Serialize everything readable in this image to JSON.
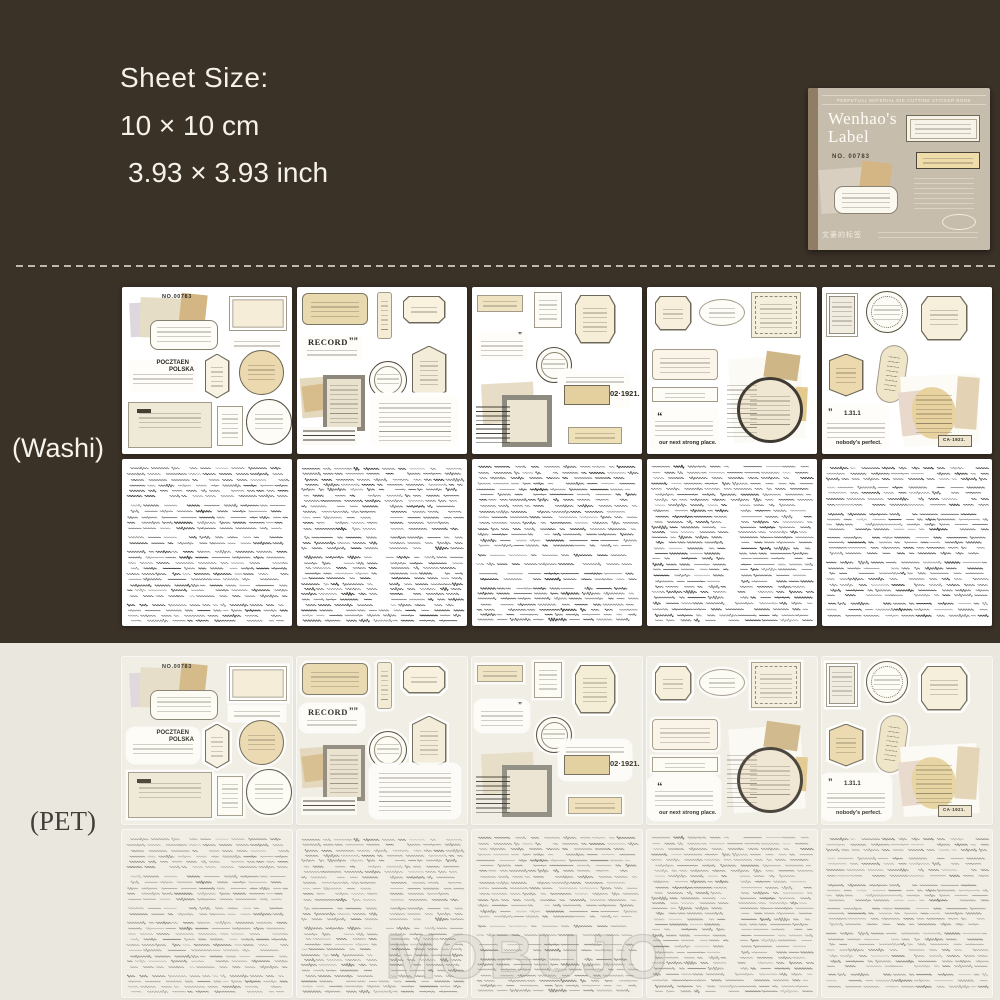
{
  "page": {
    "bg_dark": "#3a3127",
    "bg_light": "#eae7de"
  },
  "size_info": {
    "label": "Sheet Size:",
    "cm": "10 × 10 cm",
    "inch": "3.93 × 3.93 inch"
  },
  "package": {
    "series_line": "PERPETUAL MATERIAL DIE-CUTTING STICKER BOOK",
    "title_line1": "Wenhao's",
    "title_line2": "Label",
    "item_no": "NO. 00783",
    "bottom_label_cn": "文豪的标签"
  },
  "materials": {
    "washi": "(Washi)",
    "pet": "(PET)"
  },
  "sticker_texts": {
    "item_no": "NO.00783",
    "postal1": "POCZTAEN",
    "postal2": "POLSKA",
    "record": "RECORD",
    "record_quotes": "””",
    "date_1921": "02·1921.",
    "open_quote": "“",
    "close_quotes": "”",
    "strong_place": "our next strong place.",
    "quote_nums": "1.31.1",
    "perfect": "nobody's perfect.",
    "ca_1921": "CA·1921."
  },
  "watermark": "MOBUJO"
}
